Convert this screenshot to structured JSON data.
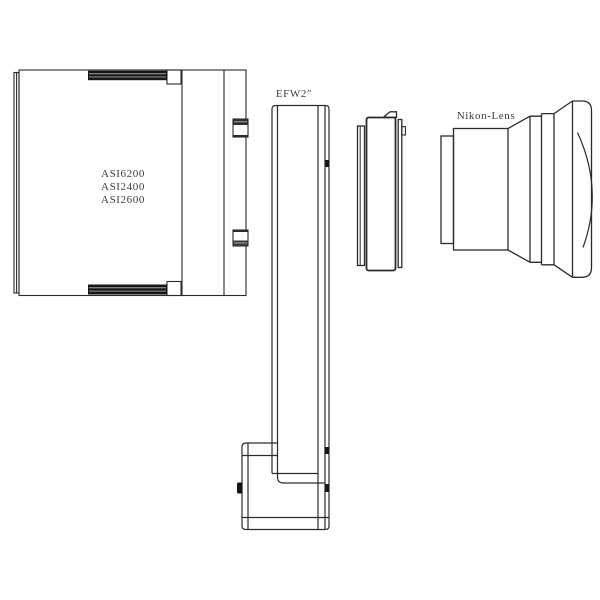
{
  "diagram": {
    "camera": {
      "label_lines": [
        "ASI6200",
        "ASI2400",
        "ASI2600"
      ]
    },
    "filter_wheel": {
      "label": "EFW2″"
    },
    "lens": {
      "label": "Nikon-Lens"
    }
  },
  "colors": {
    "line": "#2b2b2b",
    "text": "#3d3d3d",
    "hatch_dark": "#161616",
    "hatch_light": "#9a9a9a",
    "background": "#ffffff"
  }
}
